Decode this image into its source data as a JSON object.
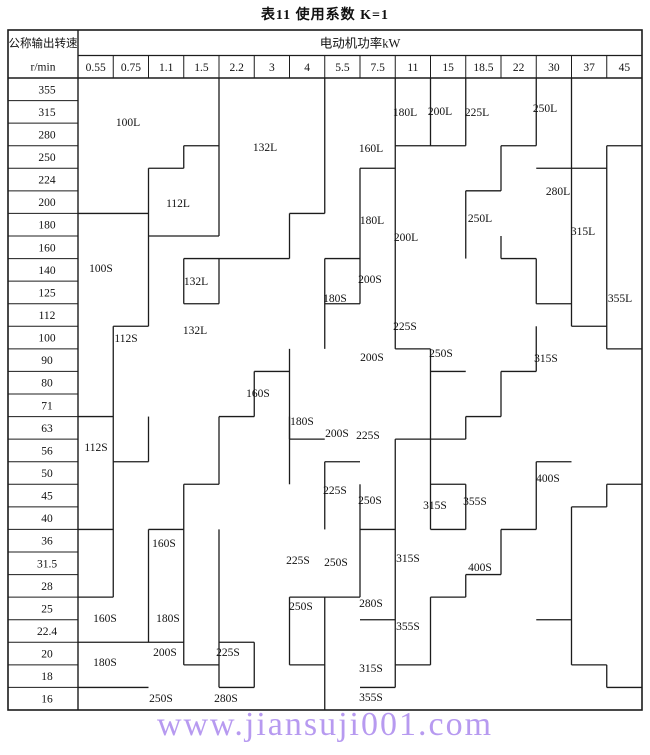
{
  "title": "表11 使用系数  K=1",
  "header": {
    "left_title": "公称输出转速",
    "left_unit": "r/min",
    "power_title": "电动机功率kW"
  },
  "watermark": {
    "text": "www.jiansuji001.com",
    "color": "#b79af0"
  },
  "colors": {
    "line": "#1c1c1c",
    "text": "#111111",
    "background": "#ffffff"
  },
  "chart_data": {
    "type": "heatmap",
    "note": "Gear reducer selection chart: stepped regions of reducer sizes over motor power (columns) vs output speed (rows)",
    "xlabel": "电动机功率kW",
    "ylabel": "公称输出转速 r/min",
    "powers_kw": [
      "0.55",
      "0.75",
      "1.1",
      "1.5",
      "2.2",
      "3",
      "4",
      "5.5",
      "7.5",
      "11",
      "15",
      "18.5",
      "22",
      "30",
      "37",
      "45"
    ],
    "speeds_rpm": [
      "355",
      "315",
      "280",
      "250",
      "224",
      "200",
      "180",
      "160",
      "140",
      "125",
      "112",
      "100",
      "90",
      "80",
      "71",
      "63",
      "56",
      "50",
      "45",
      "40",
      "36",
      "31.5",
      "28",
      "25",
      "22.4",
      "20",
      "18",
      "16"
    ],
    "region_labels": [
      {
        "text": "100L",
        "x": 128,
        "y": 122
      },
      {
        "text": "112L",
        "x": 178,
        "y": 203
      },
      {
        "text": "132L",
        "x": 265,
        "y": 147
      },
      {
        "text": "160L",
        "x": 371,
        "y": 148
      },
      {
        "text": "180L",
        "x": 405,
        "y": 112
      },
      {
        "text": "200L",
        "x": 440,
        "y": 111
      },
      {
        "text": "225L",
        "x": 477,
        "y": 112
      },
      {
        "text": "250L",
        "x": 545,
        "y": 108
      },
      {
        "text": "280L",
        "x": 558,
        "y": 191
      },
      {
        "text": "250L",
        "x": 480,
        "y": 218
      },
      {
        "text": "315L",
        "x": 583,
        "y": 231
      },
      {
        "text": "180L",
        "x": 372,
        "y": 220
      },
      {
        "text": "200L",
        "x": 406,
        "y": 237
      },
      {
        "text": "100S",
        "x": 101,
        "y": 268
      },
      {
        "text": "200S",
        "x": 370,
        "y": 279
      },
      {
        "text": "132L",
        "x": 196,
        "y": 281
      },
      {
        "text": "180S",
        "x": 335,
        "y": 298
      },
      {
        "text": "355L",
        "x": 620,
        "y": 298
      },
      {
        "text": "132L",
        "x": 195,
        "y": 330
      },
      {
        "text": "112S",
        "x": 126,
        "y": 338
      },
      {
        "text": "225S",
        "x": 405,
        "y": 326
      },
      {
        "text": "250S",
        "x": 441,
        "y": 353
      },
      {
        "text": "315S",
        "x": 546,
        "y": 358
      },
      {
        "text": "200S",
        "x": 372,
        "y": 357
      },
      {
        "text": "160S",
        "x": 258,
        "y": 393
      },
      {
        "text": "180S",
        "x": 302,
        "y": 421
      },
      {
        "text": "112S",
        "x": 96,
        "y": 447
      },
      {
        "text": "200S",
        "x": 337,
        "y": 433
      },
      {
        "text": "225S",
        "x": 368,
        "y": 435
      },
      {
        "text": "225S",
        "x": 335,
        "y": 490
      },
      {
        "text": "250S",
        "x": 370,
        "y": 500
      },
      {
        "text": "315S",
        "x": 435,
        "y": 505
      },
      {
        "text": "355S",
        "x": 475,
        "y": 501
      },
      {
        "text": "400S",
        "x": 548,
        "y": 478
      },
      {
        "text": "160S",
        "x": 164,
        "y": 543
      },
      {
        "text": "315S",
        "x": 408,
        "y": 558
      },
      {
        "text": "225S",
        "x": 298,
        "y": 560
      },
      {
        "text": "250S",
        "x": 336,
        "y": 562
      },
      {
        "text": "400S",
        "x": 480,
        "y": 567
      },
      {
        "text": "160S",
        "x": 105,
        "y": 618
      },
      {
        "text": "180S",
        "x": 168,
        "y": 618
      },
      {
        "text": "250S",
        "x": 301,
        "y": 606
      },
      {
        "text": "280S",
        "x": 371,
        "y": 603
      },
      {
        "text": "355S",
        "x": 408,
        "y": 626
      },
      {
        "text": "180S",
        "x": 105,
        "y": 662
      },
      {
        "text": "200S",
        "x": 165,
        "y": 652
      },
      {
        "text": "225S",
        "x": 228,
        "y": 652
      },
      {
        "text": "315S",
        "x": 371,
        "y": 668
      },
      {
        "text": "250S",
        "x": 161,
        "y": 698
      },
      {
        "text": "280S",
        "x": 226,
        "y": 698
      },
      {
        "text": "355S",
        "x": 371,
        "y": 697
      }
    ],
    "boundaries": {
      "comment": "o:v => vertical at column-edge index c spanning row-edges f..t ; o:h => horizontal at row-edge index r spanning column-edges f..t",
      "segments": [
        {
          "o": "v",
          "c": 4,
          "f": 0,
          "t": 7
        },
        {
          "o": "v",
          "c": 3,
          "f": 3,
          "t": 4
        },
        {
          "o": "v",
          "c": 2,
          "f": 4,
          "t": 11
        },
        {
          "o": "v",
          "c": 3,
          "f": 8,
          "t": 10
        },
        {
          "o": "v",
          "c": 4,
          "f": 8,
          "t": 10
        },
        {
          "o": "v",
          "c": 6,
          "f": 6,
          "t": 8
        },
        {
          "o": "v",
          "c": 7,
          "f": 0,
          "t": 6
        },
        {
          "o": "v",
          "c": 1,
          "f": 11,
          "t": 23
        },
        {
          "o": "v",
          "c": 2,
          "f": 15,
          "t": 17
        },
        {
          "o": "v",
          "c": 2,
          "f": 20,
          "t": 25
        },
        {
          "o": "v",
          "c": 3,
          "f": 18,
          "t": 20
        },
        {
          "o": "v",
          "c": 3,
          "f": 20,
          "t": 26
        },
        {
          "o": "v",
          "c": 4,
          "f": 15,
          "t": 18
        },
        {
          "o": "v",
          "c": 4,
          "f": 20,
          "t": 27
        },
        {
          "o": "v",
          "c": 5,
          "f": 13,
          "t": 15
        },
        {
          "o": "v",
          "c": 5,
          "f": 25,
          "t": 27
        },
        {
          "o": "v",
          "c": 6,
          "f": 12,
          "t": 16
        },
        {
          "o": "v",
          "c": 6,
          "f": 15,
          "t": 18
        },
        {
          "o": "v",
          "c": 6,
          "f": 23,
          "t": 26
        },
        {
          "o": "v",
          "c": 7,
          "f": 8,
          "t": 12
        },
        {
          "o": "v",
          "c": 7,
          "f": 17,
          "t": 20
        },
        {
          "o": "v",
          "c": 7,
          "f": 23,
          "t": 28
        },
        {
          "o": "v",
          "c": 8,
          "f": 4,
          "t": 10
        },
        {
          "o": "v",
          "c": 8,
          "f": 18,
          "t": 23
        },
        {
          "o": "v",
          "c": 9,
          "f": 0,
          "t": 12
        },
        {
          "o": "v",
          "c": 9,
          "f": 16,
          "t": 27
        },
        {
          "o": "v",
          "c": 10,
          "f": 0,
          "t": 3
        },
        {
          "o": "v",
          "c": 10,
          "f": 12,
          "t": 20
        },
        {
          "o": "v",
          "c": 10,
          "f": 23,
          "t": 26
        },
        {
          "o": "v",
          "c": 11,
          "f": 0,
          "t": 3
        },
        {
          "o": "v",
          "c": 11,
          "f": 5,
          "t": 8
        },
        {
          "o": "v",
          "c": 11,
          "f": 15,
          "t": 16
        },
        {
          "o": "v",
          "c": 11,
          "f": 18,
          "t": 20
        },
        {
          "o": "v",
          "c": 11,
          "f": 22,
          "t": 23
        },
        {
          "o": "v",
          "c": 12,
          "f": 3,
          "t": 5
        },
        {
          "o": "v",
          "c": 12,
          "f": 7,
          "t": 8
        },
        {
          "o": "v",
          "c": 12,
          "f": 13,
          "t": 15
        },
        {
          "o": "v",
          "c": 12,
          "f": 20,
          "t": 22
        },
        {
          "o": "v",
          "c": 13,
          "f": 0,
          "t": 3
        },
        {
          "o": "v",
          "c": 13,
          "f": 8,
          "t": 10
        },
        {
          "o": "v",
          "c": 13,
          "f": 11,
          "t": 13
        },
        {
          "o": "v",
          "c": 13,
          "f": 17,
          "t": 20
        },
        {
          "o": "v",
          "c": 14,
          "f": 0,
          "t": 11
        },
        {
          "o": "v",
          "c": 14,
          "f": 19,
          "t": 26
        },
        {
          "o": "v",
          "c": 15,
          "f": 3,
          "t": 12
        },
        {
          "o": "v",
          "c": 15,
          "f": 18,
          "t": 19
        },
        {
          "o": "v",
          "c": 15,
          "f": 26,
          "t": 27
        },
        {
          "o": "h",
          "r": 3,
          "f": 3,
          "t": 4
        },
        {
          "o": "h",
          "r": 4,
          "f": 2,
          "t": 3
        },
        {
          "o": "h",
          "r": 6,
          "f": 0,
          "t": 2
        },
        {
          "o": "h",
          "r": 7,
          "f": 2,
          "t": 4
        },
        {
          "o": "h",
          "r": 8,
          "f": 3,
          "t": 4
        },
        {
          "o": "h",
          "r": 10,
          "f": 3,
          "t": 4
        },
        {
          "o": "h",
          "r": 8,
          "f": 4,
          "t": 6
        },
        {
          "o": "h",
          "r": 6,
          "f": 6,
          "t": 7
        },
        {
          "o": "h",
          "r": 8,
          "f": 7,
          "t": 8
        },
        {
          "o": "h",
          "r": 10,
          "f": 7,
          "t": 8
        },
        {
          "o": "h",
          "r": 4,
          "f": 8,
          "t": 9
        },
        {
          "o": "h",
          "r": 3,
          "f": 9,
          "t": 10
        },
        {
          "o": "h",
          "r": 3,
          "f": 10,
          "t": 11
        },
        {
          "o": "h",
          "r": 5,
          "f": 11,
          "t": 12
        },
        {
          "o": "h",
          "r": 3,
          "f": 12,
          "t": 13
        },
        {
          "o": "h",
          "r": 4,
          "f": 13,
          "t": 14
        },
        {
          "o": "h",
          "r": 4,
          "f": 14,
          "t": 15
        },
        {
          "o": "h",
          "r": 3,
          "f": 15,
          "t": 16
        },
        {
          "o": "h",
          "r": 8,
          "f": 12,
          "t": 13
        },
        {
          "o": "h",
          "r": 10,
          "f": 13,
          "t": 14
        },
        {
          "o": "h",
          "r": 11,
          "f": 14,
          "t": 15
        },
        {
          "o": "h",
          "r": 12,
          "f": 15,
          "t": 16
        },
        {
          "o": "h",
          "r": 11,
          "f": 1,
          "t": 2
        },
        {
          "o": "h",
          "r": 15,
          "f": 0,
          "t": 1
        },
        {
          "o": "h",
          "r": 17,
          "f": 1,
          "t": 2
        },
        {
          "o": "h",
          "r": 20,
          "f": 0,
          "t": 1
        },
        {
          "o": "h",
          "r": 20,
          "f": 2,
          "t": 3
        },
        {
          "o": "h",
          "r": 18,
          "f": 3,
          "t": 4
        },
        {
          "o": "h",
          "r": 23,
          "f": 0,
          "t": 1
        },
        {
          "o": "h",
          "r": 25,
          "f": 0,
          "t": 3
        },
        {
          "o": "h",
          "r": 26,
          "f": 3,
          "t": 4
        },
        {
          "o": "h",
          "r": 27,
          "f": 0,
          "t": 2
        },
        {
          "o": "h",
          "r": 25,
          "f": 4,
          "t": 5
        },
        {
          "o": "h",
          "r": 27,
          "f": 4,
          "t": 5
        },
        {
          "o": "h",
          "r": 13,
          "f": 5,
          "t": 6
        },
        {
          "o": "h",
          "r": 15,
          "f": 4,
          "t": 5
        },
        {
          "o": "h",
          "r": 16,
          "f": 6,
          "t": 7
        },
        {
          "o": "h",
          "r": 17,
          "f": 7,
          "t": 8
        },
        {
          "o": "h",
          "r": 23,
          "f": 6,
          "t": 8
        },
        {
          "o": "h",
          "r": 26,
          "f": 6,
          "t": 7
        },
        {
          "o": "h",
          "r": 24,
          "f": 8,
          "t": 9
        },
        {
          "o": "h",
          "r": 27,
          "f": 8,
          "t": 9
        },
        {
          "o": "h",
          "r": 20,
          "f": 8,
          "t": 9
        },
        {
          "o": "h",
          "r": 16,
          "f": 9,
          "t": 10
        },
        {
          "o": "h",
          "r": 12,
          "f": 9,
          "t": 10
        },
        {
          "o": "h",
          "r": 26,
          "f": 9,
          "t": 10
        },
        {
          "o": "h",
          "r": 23,
          "f": 10,
          "t": 11
        },
        {
          "o": "h",
          "r": 18,
          "f": 10,
          "t": 11
        },
        {
          "o": "h",
          "r": 20,
          "f": 10,
          "t": 11
        },
        {
          "o": "h",
          "r": 16,
          "f": 10,
          "t": 11
        },
        {
          "o": "h",
          "r": 13,
          "f": 10,
          "t": 11
        },
        {
          "o": "h",
          "r": 13,
          "f": 12,
          "t": 13
        },
        {
          "o": "h",
          "r": 15,
          "f": 11,
          "t": 12
        },
        {
          "o": "h",
          "r": 22,
          "f": 11,
          "t": 12
        },
        {
          "o": "h",
          "r": 20,
          "f": 12,
          "t": 13
        },
        {
          "o": "h",
          "r": 17,
          "f": 13,
          "t": 14
        },
        {
          "o": "h",
          "r": 24,
          "f": 13,
          "t": 14
        },
        {
          "o": "h",
          "r": 19,
          "f": 14,
          "t": 15
        },
        {
          "o": "h",
          "r": 18,
          "f": 15,
          "t": 16
        },
        {
          "o": "h",
          "r": 26,
          "f": 14,
          "t": 15
        },
        {
          "o": "h",
          "r": 27,
          "f": 15,
          "t": 16
        },
        {
          "o": "h",
          "r": 5,
          "f": 11,
          "t": 12
        }
      ]
    }
  }
}
